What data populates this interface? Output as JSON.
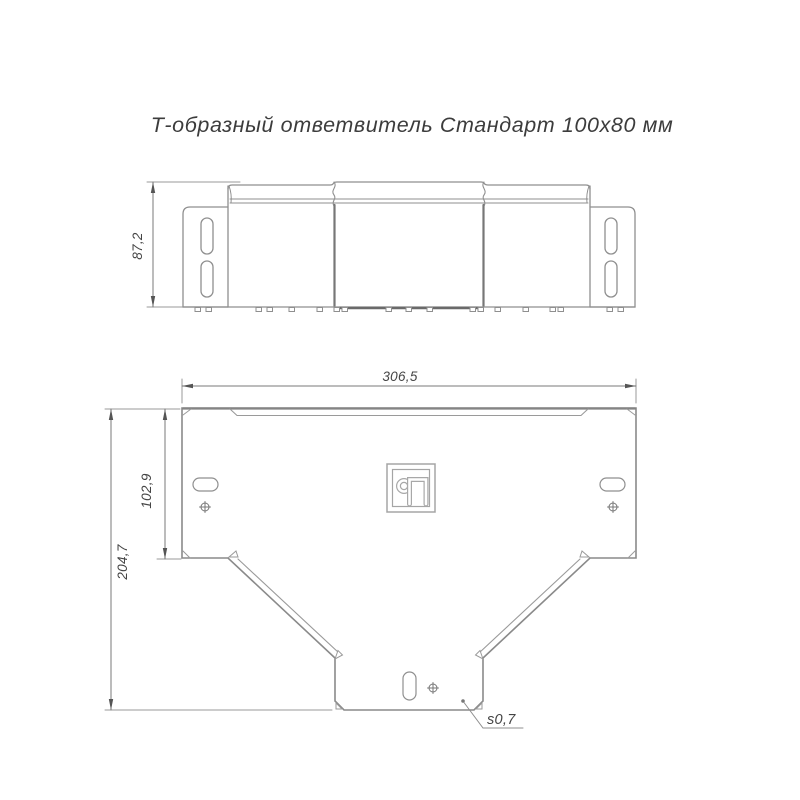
{
  "title": "Т-образный ответвитель Стандарт 100х80 мм",
  "side_view": {
    "height_dim": "87,2"
  },
  "plan_view": {
    "width_dim": "306,5",
    "branch_depth_dim": "102,9",
    "total_depth_dim": "204,7",
    "thickness_note": "s0,7"
  },
  "logo": "manufacturer-mark",
  "colors": {
    "line": "#8f8f8f",
    "dark_line": "#6e6e6e",
    "dim_line": "#7a7a7a",
    "arrow": "#555555",
    "text": "#454545",
    "background": "#ffffff"
  }
}
